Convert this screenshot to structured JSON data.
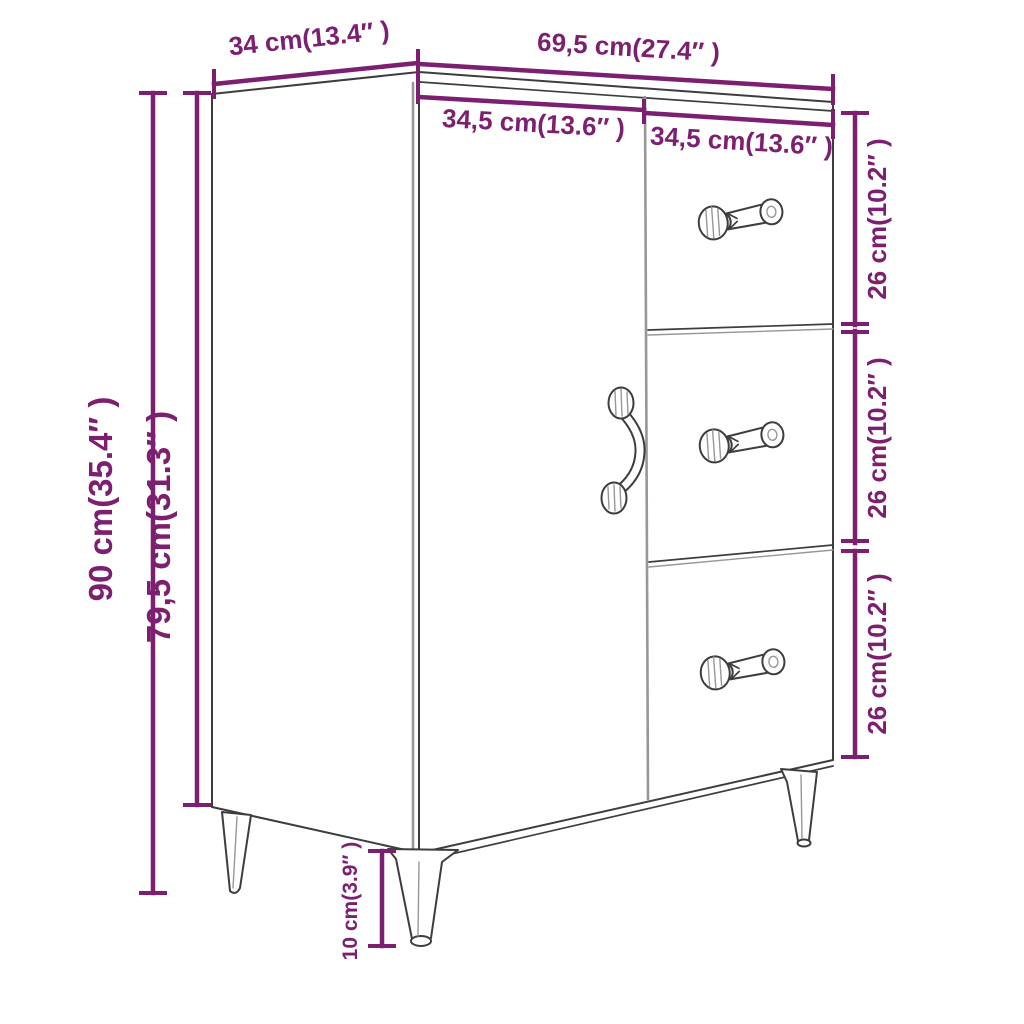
{
  "diagram": {
    "title": "Sideboard dimension diagram",
    "colors": {
      "dimension": "#7d1f70",
      "outline": "#3d3d3d",
      "light_line": "#979797",
      "background": "#ffffff"
    },
    "dimensions": {
      "top_depth": "34 cm(13.4″ )",
      "top_width": "69,5 cm(27.4″ )",
      "door_width": "34,5 cm(13.6″ )",
      "drawer_width": "34,5 cm(13.6″ )",
      "total_height": "90 cm(35.4″ )",
      "body_height": "79,5 cm(31.3″ )",
      "drawer1_height": "26 cm(10.2″ )",
      "drawer2_height": "26 cm(10.2″ )",
      "drawer3_height": "26 cm(10.2″ )",
      "leg_height": "10 cm(3.9″ )"
    }
  }
}
